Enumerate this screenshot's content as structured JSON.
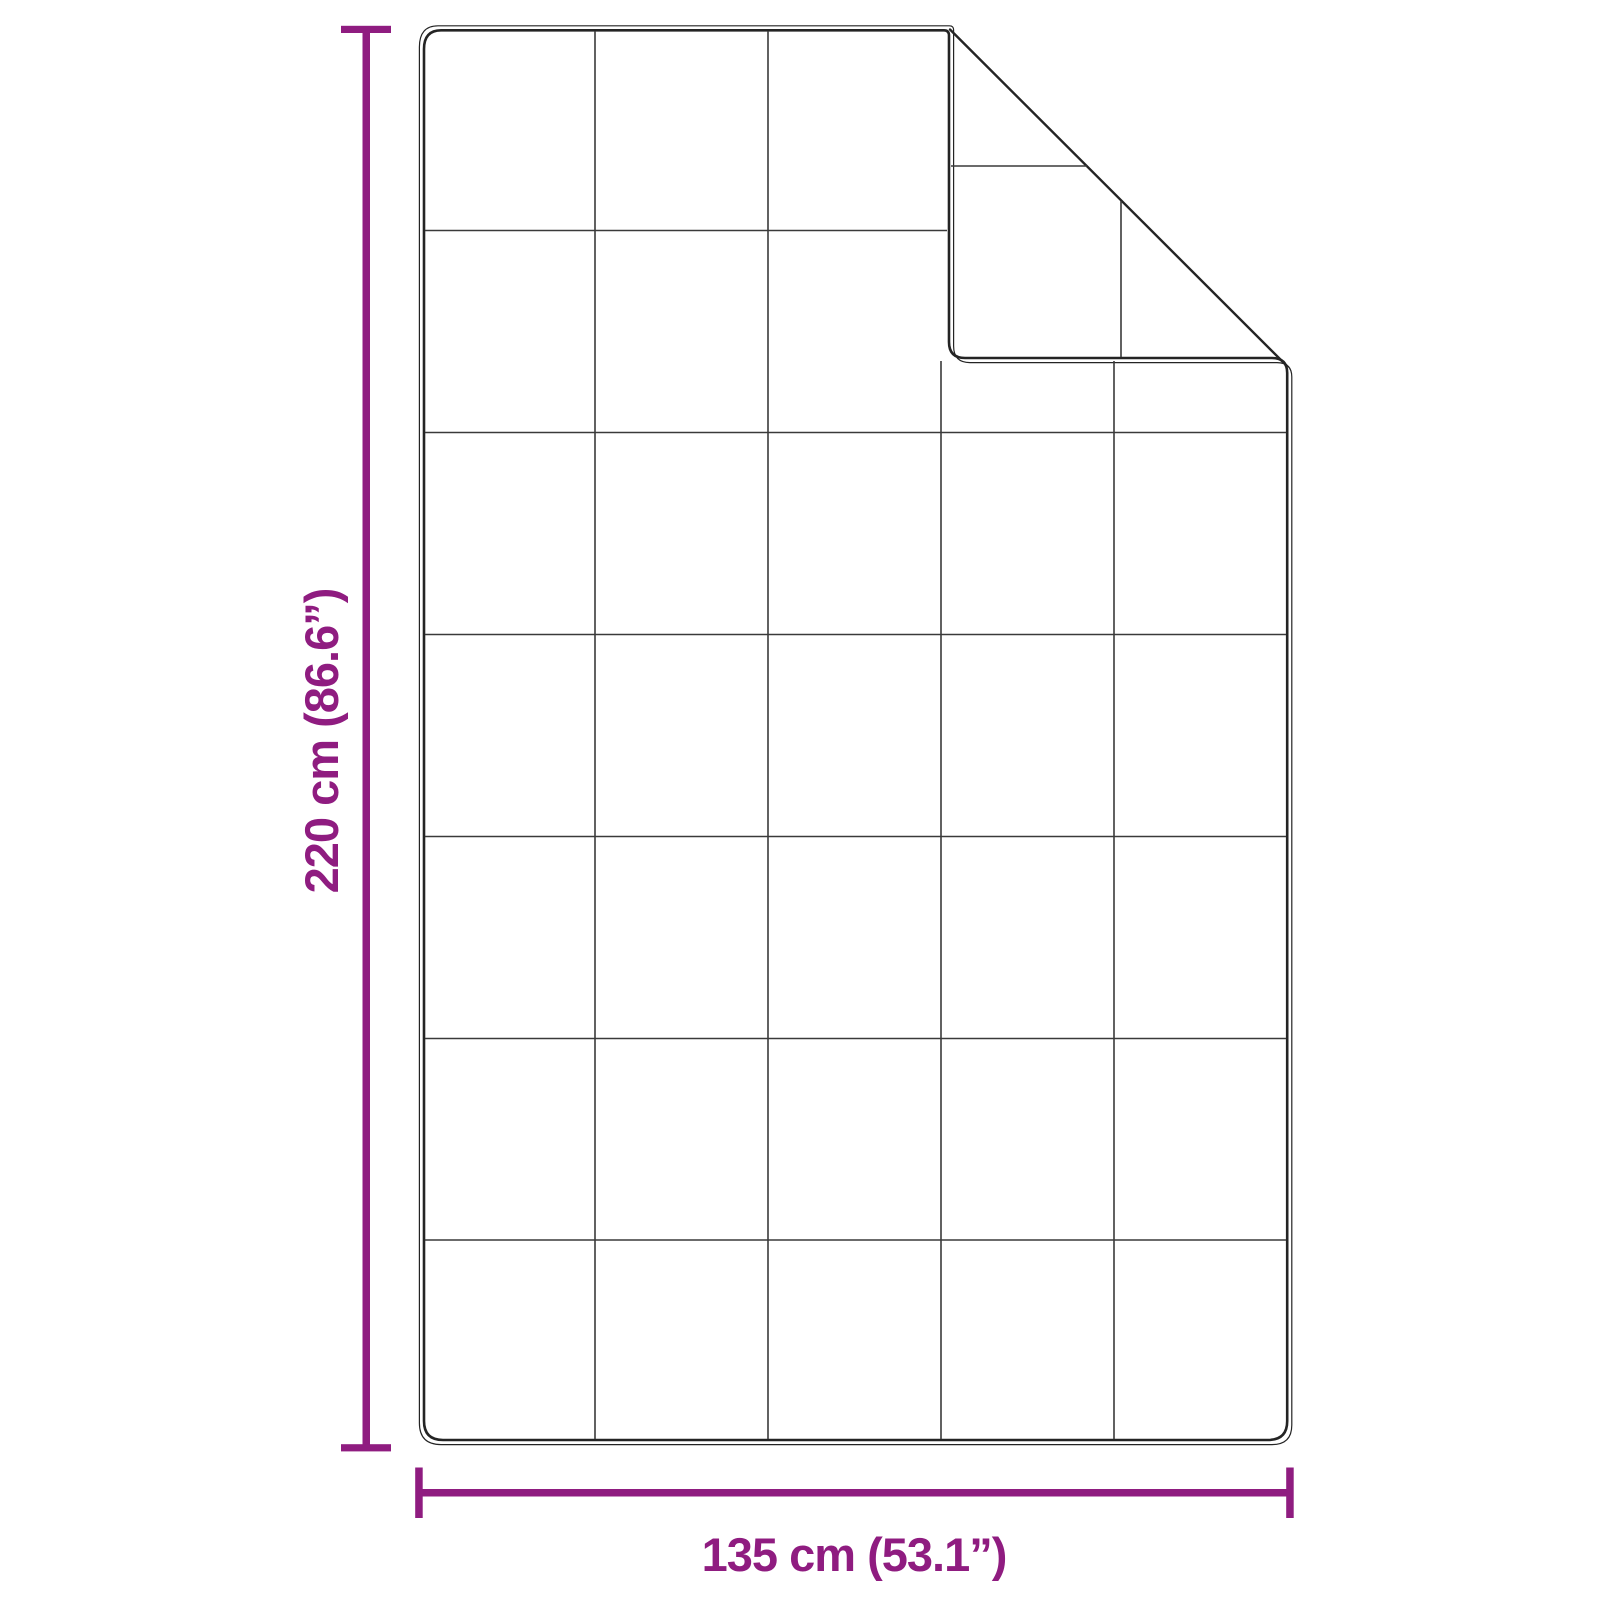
{
  "colors": {
    "accent": "#8F1C80",
    "outline": "#242424",
    "grid": "#3a3a3a",
    "bg": "#ffffff"
  },
  "dimensions": {
    "height_label": "220 cm (86.6”)",
    "width_label": "135 cm (53.1”)"
  },
  "figure": {
    "subject": "blanket with folded top-right corner",
    "quilt_grid_columns": 5,
    "quilt_grid_rows": 7
  }
}
